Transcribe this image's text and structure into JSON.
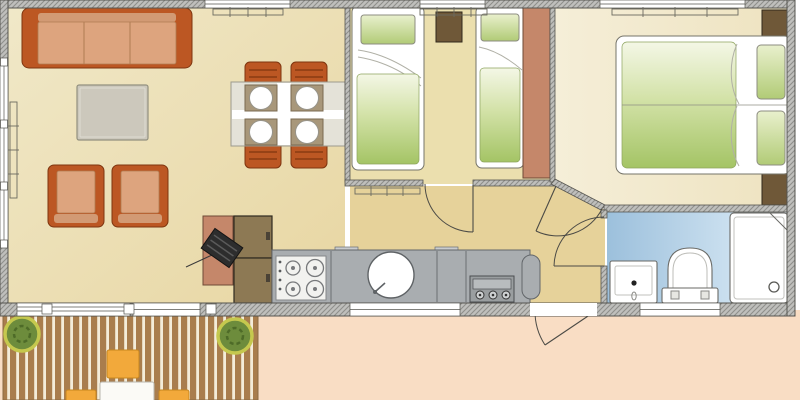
{
  "meta": {
    "type": "floor-plan",
    "description": "Top-down architectural floor plan of a two-bedroom holiday mobile home with living room, kitchen, twin bedroom, double bedroom, bathroom, hallway and wooden terrace"
  },
  "colors": {
    "outside": "#f9ddc4",
    "floor_living": "#efe5c0",
    "floor_living2": "#e8d6a2",
    "floor_hall": "#e6d29a",
    "floor_twin": "#ebdfae",
    "floor_double": "#f3ecd3",
    "wall_line": "#55544f",
    "line": "#4c4b46",
    "terracotta": "#bc5723",
    "cushion": "#dda47e",
    "coffee_table": "#ccc8bc",
    "dining_table": "#e4e2d8",
    "placemat": "#a8977a",
    "wood_dark": "#6f5838",
    "cabinet_brown": "#8d7954",
    "salmon": "#c5876a",
    "counter": "#a9adb0",
    "appliance_panel": "#84898c",
    "bed_green": "#a4c465",
    "bed_green_light": "#f4f7e6",
    "pillow_green": "#c3d88a",
    "bath_blue": "#9cc0dc",
    "bath_blue_light": "#e0eef8",
    "deck_plank": "#a97d4d",
    "deck_gap": "#f4ecd9",
    "plant_green": "#6d8c3c",
    "plant_edge": "#c5c84e",
    "terrace_chair": "#f2a93b",
    "tv_black": "#2d2d2d"
  },
  "plan": {
    "rooms": [
      {
        "id": "living-room",
        "label": "living room",
        "furniture": [
          "three-seat-sofa",
          "coffee-table",
          "armchair",
          "armchair",
          "tv-cabinet",
          "television",
          "storage-cabinets"
        ]
      },
      {
        "id": "dining-area",
        "label": "dining area",
        "furniture": [
          "dining-table",
          "dining-chair x4",
          "place-setting x4"
        ]
      },
      {
        "id": "kitchen",
        "label": "kitchen",
        "furniture": [
          "worktop",
          "gas-hob-4-burner",
          "round-sink",
          "cooker"
        ]
      },
      {
        "id": "twin-bedroom",
        "label": "twin bedroom",
        "furniture": [
          "single-bed",
          "single-bed",
          "bedside-table",
          "wardrobe"
        ]
      },
      {
        "id": "double-bedroom",
        "label": "double bedroom",
        "furniture": [
          "double-bed",
          "bedside-table",
          "bedside-table"
        ]
      },
      {
        "id": "bathroom",
        "label": "bathroom",
        "furniture": [
          "washbasin",
          "toilet",
          "shower-tray"
        ]
      },
      {
        "id": "hallway",
        "label": "hallway",
        "furniture": []
      },
      {
        "id": "terrace",
        "label": "wooden terrace",
        "furniture": [
          "decking",
          "potted-plant",
          "potted-plant",
          "garden-table",
          "garden-chair x3"
        ]
      }
    ],
    "doors": [
      "twin-bedroom-door",
      "double-bedroom-door",
      "bathroom-door",
      "entrance-door"
    ],
    "windows": {
      "top_wall": 3,
      "left_wall": 1,
      "bottom_wall": 4
    }
  }
}
